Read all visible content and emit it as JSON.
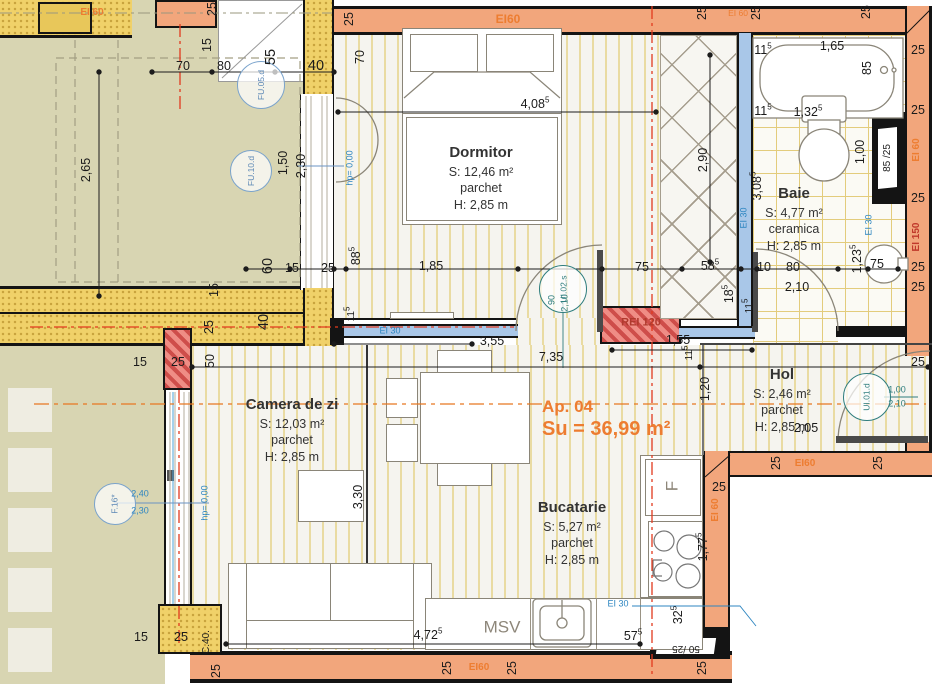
{
  "header": {
    "apartment": "Ap. 04",
    "area_total": "Su = 36,99 m²"
  },
  "rooms": {
    "dormitor": {
      "name": "Dormitor",
      "area": "S: 12,46 m²",
      "floor": "parchet",
      "height": "H: 2,85 m"
    },
    "baie": {
      "name": "Baie",
      "area": "S: 4,77 m²",
      "floor": "ceramica",
      "height": "H: 2,85 m"
    },
    "hol": {
      "name": "Hol",
      "area": "S: 2,46 m²",
      "floor": "parchet",
      "height": "H: 2,85 m"
    },
    "camera_de_zi": {
      "name": "Camera de zi",
      "area": "S: 12,03 m²",
      "floor": "parchet",
      "height": "H: 2,85 m"
    },
    "bucatarie": {
      "name": "Bucatarie",
      "area": "S: 5,27 m²",
      "floor": "parchet",
      "height": "H: 2,85 m"
    }
  },
  "door_tags": {
    "ui02": {
      "label": "UI.02.s"
    },
    "ui01": {
      "label": "UI.01.d"
    },
    "f16": {
      "label": "F.16*"
    },
    "fu05": {
      "label": "FU.05.d"
    },
    "fu10": {
      "label": "FU.10.d"
    }
  },
  "colors": {
    "fire_wall_orange": "#f2a67c",
    "insulation_yellow": "#f0d169",
    "pillar_red": "#ef8d85",
    "glazing_blue": "#a9c7e8",
    "axis_orange": "#e87722",
    "axis_red": "#e23a1e",
    "tag_teal": "#2e7d7d"
  },
  "annotations": [
    {
      "t": "70",
      "x": 183,
      "y": 66
    },
    {
      "t": "80",
      "x": 224,
      "y": 66
    },
    {
      "t": "40",
      "x": 316,
      "y": 66,
      "c": "b"
    },
    {
      "t": "55",
      "x": 271,
      "y": 57,
      "r": -90,
      "c": "b"
    },
    {
      "t": "15",
      "x": 207,
      "y": 45,
      "r": -90
    },
    {
      "t": "25",
      "x": 212,
      "y": 9,
      "r": -90
    },
    {
      "t": "2,65",
      "x": 86,
      "y": 170,
      "r": -90
    },
    {
      "t": "EI 60",
      "x": 92,
      "y": 13,
      "c": "os"
    },
    {
      "t": "25",
      "x": 349,
      "y": 19,
      "r": -90
    },
    {
      "t": "EI60",
      "x": 508,
      "y": 19,
      "c": "o"
    },
    {
      "t": "25",
      "x": 702,
      "y": 13,
      "r": -90
    },
    {
      "t": "EI 60",
      "x": 738,
      "y": 13,
      "c": "ox"
    },
    {
      "t": "25",
      "x": 756,
      "y": 13,
      "r": -90
    },
    {
      "t": "25",
      "x": 866,
      "y": 12,
      "r": -90
    },
    {
      "t": "70",
      "x": 360,
      "y": 57,
      "r": -90
    },
    {
      "t": "4,08",
      "sup": "5",
      "x": 535,
      "y": 104
    },
    {
      "t": "11",
      "sup": "5",
      "x": 763,
      "y": 50
    },
    {
      "t": "1,65",
      "x": 832,
      "y": 46
    },
    {
      "t": "85",
      "x": 867,
      "y": 68,
      "r": -90
    },
    {
      "t": "11",
      "sup": "5",
      "x": 763,
      "y": 111
    },
    {
      "t": "1,32",
      "sup": "5",
      "x": 808,
      "y": 112
    },
    {
      "t": "25",
      "x": 918,
      "y": 50
    },
    {
      "t": "25",
      "x": 918,
      "y": 110
    },
    {
      "t": "EI 60",
      "x": 917,
      "y": 150,
      "r": -90,
      "c": "os"
    },
    {
      "t": "25",
      "x": 918,
      "y": 198
    },
    {
      "t": "EI 150",
      "x": 917,
      "y": 237,
      "r": -90,
      "c": "rs"
    },
    {
      "t": "25",
      "x": 918,
      "y": 267
    },
    {
      "t": "25",
      "x": 918,
      "y": 287
    },
    {
      "t": "1,00",
      "x": 860,
      "y": 152,
      "r": -90
    },
    {
      "t": "85 /25",
      "x": 888,
      "y": 158,
      "r": -90,
      "c": "s"
    },
    {
      "t": "2,90",
      "x": 703,
      "y": 160,
      "r": -90
    },
    {
      "t": "3,08",
      "sup": "5",
      "x": 757,
      "y": 186,
      "r": -90
    },
    {
      "t": "EI 30",
      "x": 744,
      "y": 218,
      "r": -90,
      "c": "bx"
    },
    {
      "t": "EI 30",
      "x": 869,
      "y": 225,
      "r": -90,
      "c": "bx"
    },
    {
      "t": "1,23",
      "sup": "5",
      "x": 857,
      "y": 259,
      "r": -90
    },
    {
      "t": "75",
      "x": 877,
      "y": 264
    },
    {
      "t": "10",
      "x": 764,
      "y": 267
    },
    {
      "t": "80",
      "x": 793,
      "y": 267
    },
    {
      "t": "2,10",
      "x": 797,
      "y": 287
    },
    {
      "t": "60",
      "x": 268,
      "y": 266,
      "r": -90,
      "c": "b"
    },
    {
      "t": "15",
      "x": 292,
      "y": 268
    },
    {
      "t": "25",
      "x": 328,
      "y": 268
    },
    {
      "t": "88",
      "sup": "5",
      "x": 356,
      "y": 256,
      "r": -90
    },
    {
      "t": "1,85",
      "x": 431,
      "y": 266
    },
    {
      "t": "75",
      "x": 642,
      "y": 267
    },
    {
      "t": "58",
      "sup": "5",
      "x": 710,
      "y": 266
    },
    {
      "t": "18",
      "sup": "5",
      "x": 729,
      "y": 294,
      "r": -90
    },
    {
      "t": "15",
      "x": 214,
      "y": 290,
      "r": -90
    },
    {
      "t": "25",
      "x": 209,
      "y": 327,
      "r": -90
    },
    {
      "t": "40",
      "x": 264,
      "y": 322,
      "r": -90,
      "c": "b"
    },
    {
      "t": "11",
      "sup": "5",
      "x": 352,
      "y": 314,
      "r": -90,
      "c": "s"
    },
    {
      "t": "3,55",
      "x": 492,
      "y": 341
    },
    {
      "t": "REI 120",
      "x": 641,
      "y": 323,
      "c": "rei"
    },
    {
      "t": "EI 30",
      "x": 390,
      "y": 331,
      "c": "bx"
    },
    {
      "t": "1,55",
      "x": 678,
      "y": 340
    },
    {
      "t": "11",
      "sup": "5",
      "x": 690,
      "y": 353,
      "r": -90,
      "c": "s"
    },
    {
      "t": "11",
      "sup": "5",
      "x": 750,
      "y": 306,
      "r": -90,
      "c": "s"
    },
    {
      "t": "7,35",
      "x": 551,
      "y": 357
    },
    {
      "t": "25",
      "x": 918,
      "y": 362
    },
    {
      "t": "1,20",
      "x": 705,
      "y": 389,
      "r": -90
    },
    {
      "t": "2,05",
      "x": 806,
      "y": 428
    },
    {
      "t": "1,00",
      "x": 897,
      "y": 390,
      "c": "tx"
    },
    {
      "t": "2,10",
      "x": 897,
      "y": 404,
      "c": "tx"
    },
    {
      "t": "90",
      "x": 552,
      "y": 300,
      "r": -90,
      "c": "tx"
    },
    {
      "t": "2,10",
      "x": 565,
      "y": 303,
      "r": -90,
      "c": "tx"
    },
    {
      "t": "hp= 0,00",
      "x": 350,
      "y": 168,
      "r": -90,
      "c": "bx"
    },
    {
      "t": "hp= 0,00",
      "x": 205,
      "y": 503,
      "r": -90,
      "c": "bx"
    },
    {
      "t": "2,40",
      "x": 140,
      "y": 494,
      "c": "bx"
    },
    {
      "t": "2,30",
      "x": 140,
      "y": 511,
      "c": "bx"
    },
    {
      "t": "1,50",
      "x": 283,
      "y": 163,
      "r": -90
    },
    {
      "t": "2,30",
      "x": 301,
      "y": 166,
      "r": -90
    },
    {
      "t": "15",
      "x": 140,
      "y": 362
    },
    {
      "t": "25",
      "x": 178,
      "y": 362
    },
    {
      "t": "50",
      "x": 210,
      "y": 361,
      "r": -90
    },
    {
      "t": "3,30",
      "x": 358,
      "y": 497,
      "r": -90
    },
    {
      "t": "25",
      "x": 776,
      "y": 463,
      "r": -90
    },
    {
      "t": "EI60",
      "x": 805,
      "y": 464,
      "c": "os"
    },
    {
      "t": "25",
      "x": 878,
      "y": 463,
      "r": -90
    },
    {
      "t": "25",
      "x": 719,
      "y": 487
    },
    {
      "t": "EI 60",
      "x": 716,
      "y": 510,
      "r": -90,
      "c": "os"
    },
    {
      "t": "1,77",
      "sup": "5",
      "x": 703,
      "y": 547,
      "r": -90
    },
    {
      "t": "F",
      "x": 672,
      "y": 486,
      "r": -90,
      "c": "g"
    },
    {
      "t": "MSV",
      "x": 502,
      "y": 627,
      "c": "g"
    },
    {
      "t": "EI 30",
      "x": 618,
      "y": 604,
      "c": "bx"
    },
    {
      "t": "57",
      "sup": "5",
      "x": 633,
      "y": 636
    },
    {
      "t": "32",
      "sup": "5",
      "x": 678,
      "y": 615,
      "r": -90
    },
    {
      "t": "50 /25",
      "x": 686,
      "y": 648,
      "r": 180,
      "c": "s"
    },
    {
      "t": "4,72",
      "sup": "5",
      "x": 428,
      "y": 635
    },
    {
      "t": "15",
      "x": 141,
      "y": 637
    },
    {
      "t": "25",
      "x": 181,
      "y": 637
    },
    {
      "t": "C.40.",
      "x": 207,
      "y": 642,
      "r": -90,
      "c": "s"
    },
    {
      "t": "25",
      "x": 216,
      "y": 671,
      "r": -90
    },
    {
      "t": "25",
      "x": 447,
      "y": 668,
      "r": -90
    },
    {
      "t": "EI60",
      "x": 479,
      "y": 668,
      "c": "os"
    },
    {
      "t": "25",
      "x": 512,
      "y": 668,
      "r": -90
    },
    {
      "t": "25",
      "x": 702,
      "y": 668,
      "r": -90
    }
  ]
}
